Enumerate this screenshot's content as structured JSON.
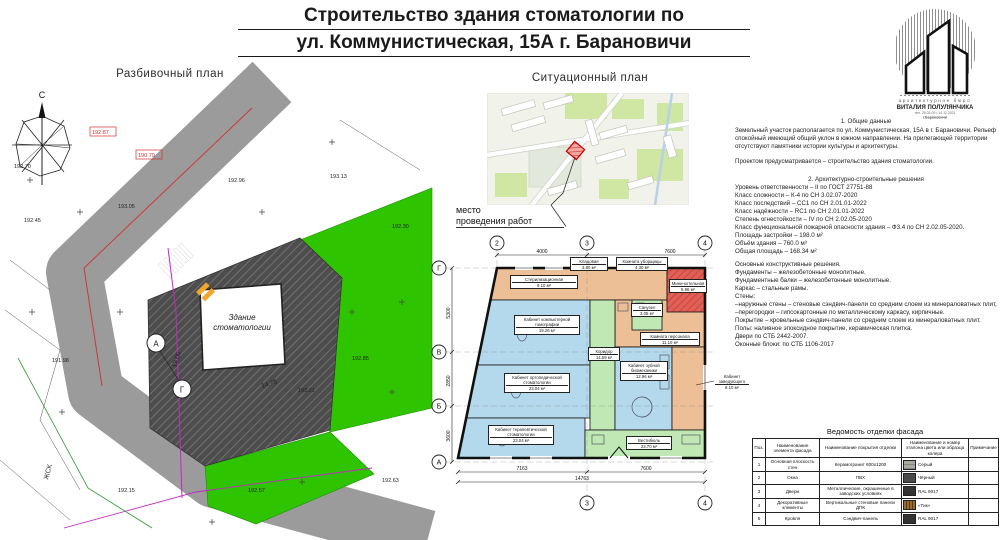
{
  "title": {
    "line1": "Строительство здания стоматологии по",
    "line2": "ул. Коммунистическая, 15А  г. Барановичи"
  },
  "logo": {
    "studio_type": "архитектурное бюро",
    "studio_name": "ВИТАЛИЯ ПОЛУЛЯНЧИКА",
    "contact": "тел. 29-02-09  •  14.12.2021",
    "city": "г.Барановичи"
  },
  "layout_plan": {
    "title": "Разбивочный план",
    "north": "С",
    "building_label_1": "Здание",
    "building_label_2": "стоматологии",
    "axis_markers": [
      "А",
      "Г"
    ],
    "dim_road": "13.05",
    "dim_bottom": "14.75",
    "zhsk": "ЖСК",
    "elevations": [
      "192.70",
      "192.87",
      "192.45",
      "193.05",
      "192.96",
      "193.13",
      "190.79",
      "192.30",
      "192.85",
      "192.57",
      "192.15",
      "191.98",
      "192.63",
      "193.21"
    ]
  },
  "situational_plan": {
    "title": "Ситуационный план",
    "marker_label_1": "место",
    "marker_label_2": "проведения работ"
  },
  "floor_plan": {
    "axes_top": [
      "2",
      "3",
      "4"
    ],
    "axes_bottom": [
      "3",
      "4"
    ],
    "axes_left": [
      "Г",
      "В",
      "Б",
      "А"
    ],
    "dims_top": [
      "4000",
      "7600"
    ],
    "dims_bottom": [
      "7163",
      "7600"
    ],
    "dim_total": "14763",
    "dims_left": [
      "5300",
      "2850",
      "3600"
    ],
    "rooms": [
      {
        "name": "Стерилизационная",
        "area": "9.10 м²"
      },
      {
        "name": "Кладовая",
        "area": "3.80 м²"
      },
      {
        "name": "Комната уборщицы",
        "area": "4.30 м²"
      },
      {
        "name": "Мини-котельная",
        "area": "5.96 м²"
      },
      {
        "name": "Кабинет компьютерной томографии",
        "area": "19.26 м²"
      },
      {
        "name": "Кабинет ортопедической стоматологии",
        "area": "23.04 м²"
      },
      {
        "name": "Кабинет терапевтической стоматологии",
        "area": "23.04 м²"
      },
      {
        "name": "Коридор",
        "area": "14.59 м²"
      },
      {
        "name": "Комната персонала",
        "area": "11.10 м²"
      },
      {
        "name": "Санузел",
        "area": "3.05 м²"
      },
      {
        "name": "Кабинет зубной биомеханики",
        "area": "12.96 м²"
      },
      {
        "name": "Кабинет заведующего",
        "area": "8.10 м²"
      },
      {
        "name": "Вестибюль",
        "area": "23.70 м²"
      }
    ]
  },
  "notes": {
    "s1_title": "1. Общие данные",
    "s1_p1": "Земельный участок располагается по ул. Коммунистическая, 15А в г. Барановичи. Рельеф спокойный имеющий общий уклон в южном направлении. На прилегающей территории отсутствуют памятники истории культуры и архитектуры.",
    "s1_p2": "Проектом предусматривается – строительство здания стоматологии.",
    "s2_title": "2. Архитектурно-строительные решения",
    "s2_lines": [
      "Уровень ответственности – II по ГОСТ 27751-88",
      "Класс сложности – К-4 по СН 3.02.07-2020",
      "Класс последствий – СС1 по СН 2.01.01-2022",
      "Класс надёжности – RC1 по СН 2.01.01-2022",
      "Степень огнестойкости – IV по СН 2.02.05-2020",
      "Класс функциональной пожарной опасности здания – Ф3.4 по СН 2.02.05-2020.",
      "Площадь застройки  – 198.0 м²",
      "Объём здания  – 760.0 м³",
      "Общая площадь  – 168.34 м²"
    ],
    "s3_lines": [
      "Основные конструктивные решения.",
      "Фундаменты – железобетонные монолитные.",
      "Фундаментные балки – железобетонные монолитные.",
      "Каркас – стальные рамы.",
      "Стены:",
      "–наружные стены – стеновые сэндвич-панели со средним слоем из минераловатных плит,",
      "–перегородки – гипсокартонные по металлическому каркасу, кирпичные.",
      "Покрытие – кровельные сэндвич-панели со средним слоем из минераловатных плит.",
      "Полы: наливное эпоксидное покрытие, керамическая плитка.",
      "Двери по СТБ 2442-2007.",
      "Оконные блоки: по СТБ 1106-2017"
    ]
  },
  "finish_table": {
    "title": "Ведомость отделки фасада",
    "headers": [
      "Поз.",
      "Наименование элемента фасада",
      "Наименование покрытия отделки",
      "Наименование и номер эталона цвета или образца колера",
      "Примечание"
    ],
    "rows": [
      {
        "pos": "1",
        "element": "Основная плоскость стен",
        "coating": "Керамогранит 600х1200",
        "color": "Серый",
        "swatch": "repeating-linear-gradient(180deg,#a9a9a4 0,#a9a9a4 3px,#878782 3px,#878782 4px)",
        "note": ""
      },
      {
        "pos": "2",
        "element": "Окна",
        "coating": "ПВХ",
        "color": "Чёрный",
        "swatch": "#4a4a4a",
        "note": ""
      },
      {
        "pos": "3",
        "element": "Двери",
        "coating": "Металлические, окрашенные в заводских условиях",
        "color": "RAL 9017",
        "swatch": "#333333",
        "note": ""
      },
      {
        "pos": "4",
        "element": "Декоративные элементы",
        "coating": "Вертикальные стеновые панели ДПК",
        "color": "«Тик»",
        "swatch": "repeating-linear-gradient(90deg,#9a6a33 0,#9a6a33 2px,#5e3a16 2px,#5e3a16 3px)",
        "note": ""
      },
      {
        "pos": "5",
        "element": "Кровля",
        "coating": "Сэндвич-панель",
        "color": "RAL 9017",
        "swatch": "#333333",
        "note": ""
      }
    ]
  }
}
